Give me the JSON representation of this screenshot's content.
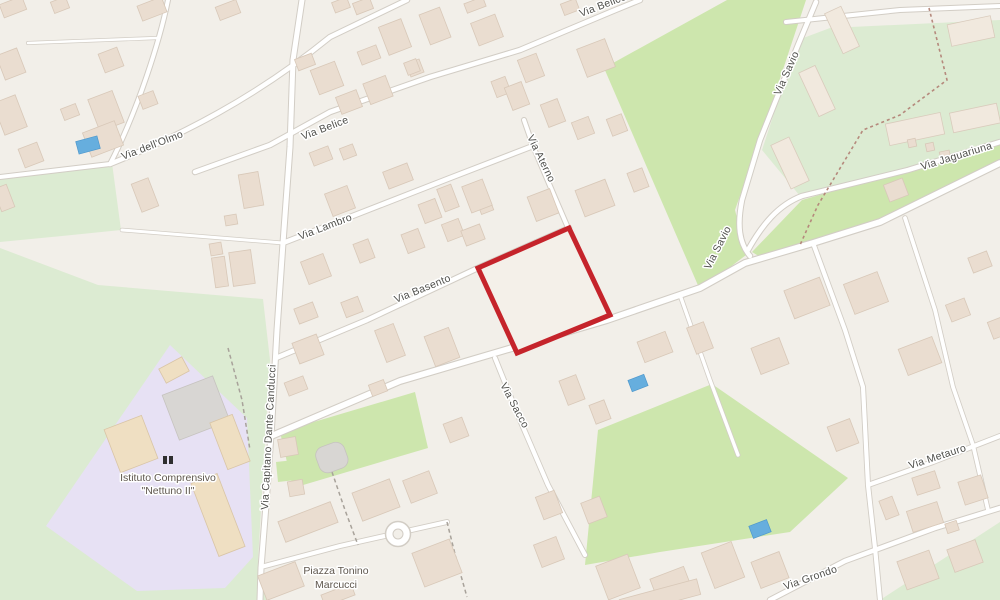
{
  "title": "Street map with highlighted parcel",
  "streets": {
    "olmo": "Via dell'Olmo",
    "belice": "Via Belice",
    "belice_top": "Via Belice",
    "lambro": "Via Lambro",
    "basento": "Via Basento",
    "aterno": "Via Aterno",
    "savio_north": "Via Savio",
    "savio_south": "Via Savio",
    "jaguariuna": "Via Jaguariuna",
    "capitano": "Via Capitano Dante Canducci",
    "sacco": "Via Sacco",
    "metauro": "Via Metauro",
    "grondo": "Via Grondo"
  },
  "places": {
    "school_line1": "Istituto Comprensivo",
    "school_line2": "\"Nettuno II\"",
    "piazza_line1": "Piazza Tonino",
    "piazza_line2": "Marcucci"
  },
  "highlight": {
    "description": "red outlined selected parcel in map center",
    "color": "#c5242b"
  },
  "colors": {
    "land": "#f2efe9",
    "grass": "#cde6ad",
    "pale_green": "#dcebd2",
    "school_area": "#e7e1f4",
    "building": "#eaddd0",
    "water": "#66aede",
    "road_fill": "#ffffff",
    "road_casing": "#d2cdc5",
    "label_text": "#4f4f4b"
  }
}
